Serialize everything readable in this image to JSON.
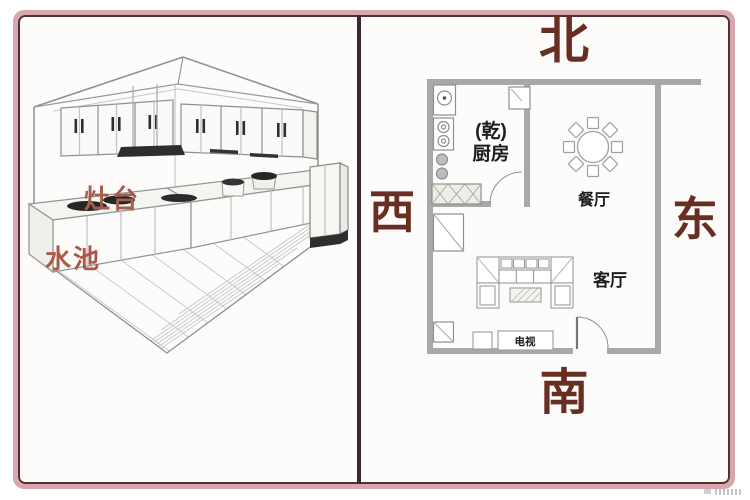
{
  "frame": {
    "outer_border_color": "#d7a6ae",
    "inner_border_color": "#533036",
    "divider_color": "#372a31",
    "plan_wall_color": "#a8a8a8",
    "direction_text_color": "#682e22",
    "left_label_color": "#a65c4a"
  },
  "panels": {
    "left": {
      "type": "3d-kitchen-line-illustration",
      "labels": {
        "stove": "灶台",
        "sink": "水池"
      }
    },
    "right": {
      "type": "floor-plan",
      "directions": {
        "north": "北",
        "west": "西",
        "east": "东",
        "south": "南"
      },
      "rooms": {
        "kitchen_annotation": "(乾)",
        "kitchen": "厨房",
        "dining": "餐厅",
        "living": "客厅",
        "tv": "电视"
      }
    }
  }
}
